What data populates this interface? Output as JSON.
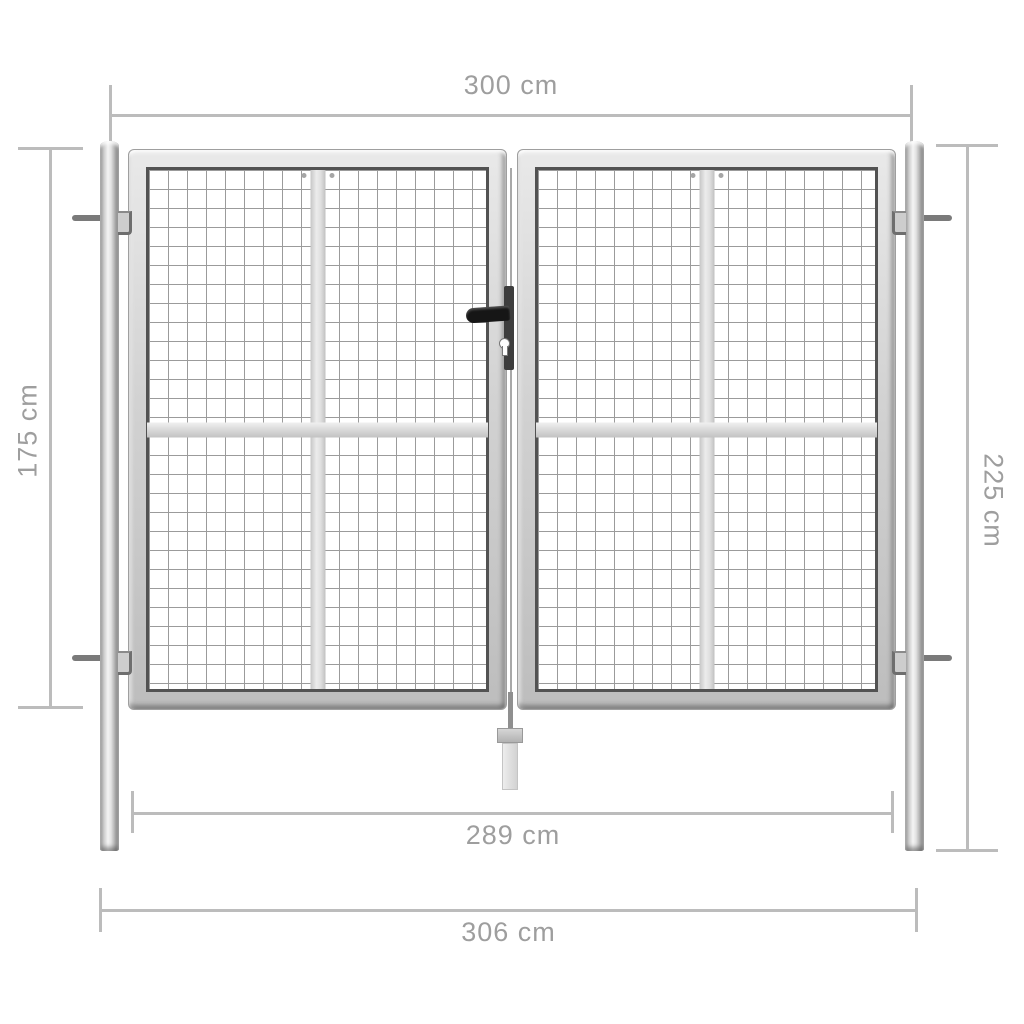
{
  "diagram": {
    "product": "double-mesh-garden-gate",
    "dimensions": {
      "top_width": "300 cm",
      "gate_height": "175 cm",
      "post_height": "225 cm",
      "inner_width": "289 cm",
      "outer_width": "306 cm"
    },
    "colors": {
      "background": "#ffffff",
      "dimension_line": "#bcbcbc",
      "dimension_text": "#9e9e9e",
      "metal_light": "#f2f2f2",
      "metal_mid": "#cfcfcf",
      "metal_dark": "#8a8a8a",
      "mesh_line": "#9b9b9b",
      "mesh_border": "#525252",
      "lock_black": "#161616"
    }
  }
}
